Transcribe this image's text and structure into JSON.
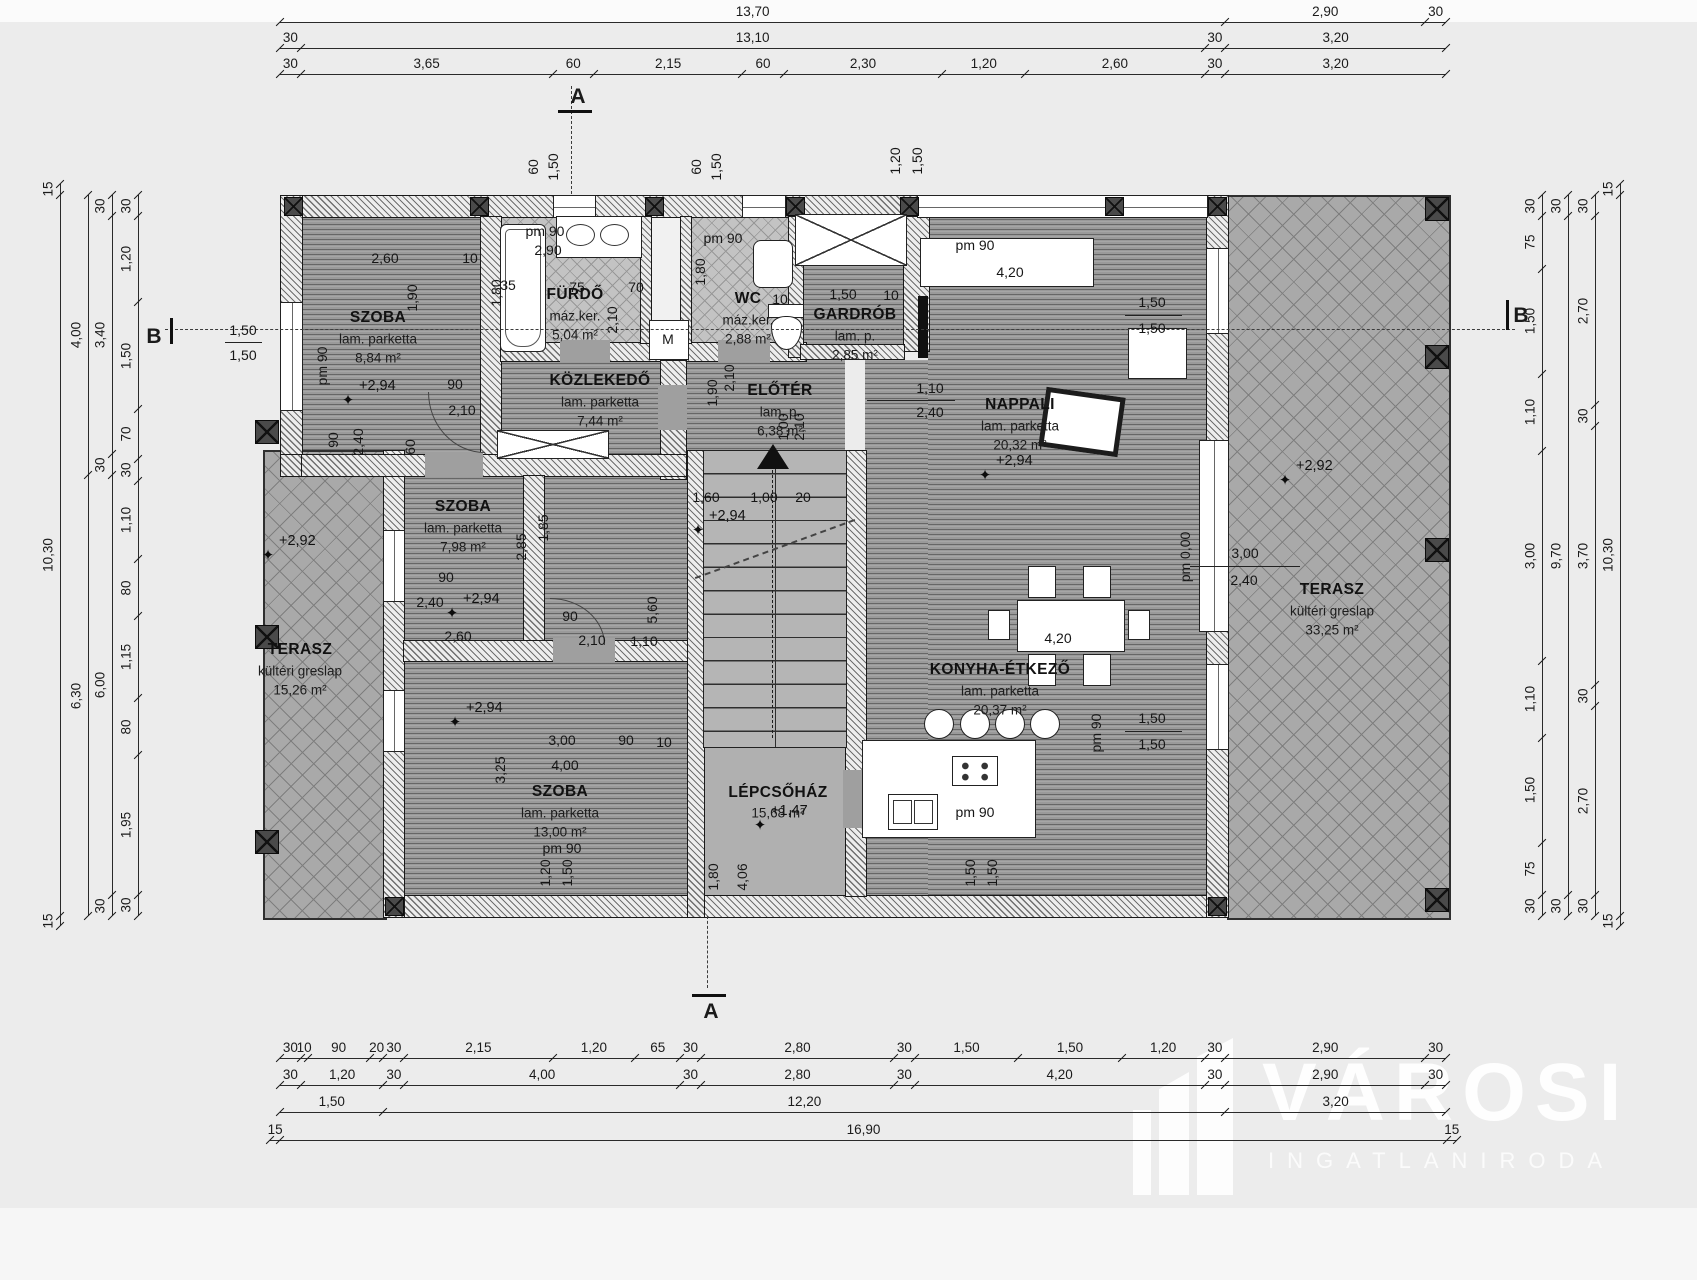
{
  "logo": {
    "name": "VÁROSI",
    "subtitle": "INGATLANIRODA"
  },
  "sections": {
    "a": "A",
    "b": "B"
  },
  "rooms": [
    {
      "name": "SZOBA",
      "finish": "lam. parketta",
      "area": "8,84 m²",
      "x": 378,
      "y": 318
    },
    {
      "name": "FÜRDŐ",
      "finish": "máz.ker.",
      "area": "5,04 m²",
      "x": 575,
      "y": 295
    },
    {
      "name": "WC",
      "finish": "máz.ker.",
      "area": "2,88 m²",
      "x": 748,
      "y": 299
    },
    {
      "name": "GARDRÓB",
      "finish": "lam. p.",
      "area": "2,85 m²",
      "x": 855,
      "y": 315
    },
    {
      "name": "KÖZLEKEDŐ",
      "finish": "lam. parketta",
      "area": "7,44 m²",
      "x": 600,
      "y": 381
    },
    {
      "name": "ELŐTÉR",
      "finish": "lam. p.",
      "area": "6,38 m²",
      "x": 780,
      "y": 391
    },
    {
      "name": "NAPPALI",
      "finish": "lam. parketta",
      "area": "20,32 m²",
      "x": 1020,
      "y": 405
    },
    {
      "name": "SZOBA",
      "finish": "lam. parketta",
      "area": "7,98 m²",
      "x": 463,
      "y": 507
    },
    {
      "name": "SZOBA",
      "finish": "lam. parketta",
      "area": "13,00 m²",
      "x": 560,
      "y": 792
    },
    {
      "name": "KONYHA-ÉTKEZŐ",
      "finish": "lam. parketta",
      "area": "20,37 m²",
      "x": 1000,
      "y": 670
    },
    {
      "name": "LÉPCSŐHÁZ",
      "finish": "",
      "area": "15,68 m²",
      "x": 778,
      "y": 793
    },
    {
      "name": "TERASZ",
      "finish": "kültéri greslap",
      "area": "15,26 m²",
      "x": 300,
      "y": 650
    },
    {
      "name": "TERASZ",
      "finish": "kültéri greslap",
      "area": "33,25 m²",
      "x": 1332,
      "y": 590
    }
  ],
  "levels": [
    {
      "v": "+2,94",
      "x": 348,
      "y": 400
    },
    {
      "v": "+2,94",
      "x": 452,
      "y": 613
    },
    {
      "v": "+2,94",
      "x": 455,
      "y": 722
    },
    {
      "v": "+2,94",
      "x": 698,
      "y": 530
    },
    {
      "v": "+2,94",
      "x": 985,
      "y": 475
    },
    {
      "v": "+1,47",
      "x": 760,
      "y": 825
    },
    {
      "v": "+2,92",
      "x": 268,
      "y": 555
    },
    {
      "v": "+2,92",
      "x": 1285,
      "y": 480
    }
  ],
  "dims": [
    {
      "t": "2,60",
      "x": 385,
      "y": 258
    },
    {
      "t": "10",
      "x": 470,
      "y": 258
    },
    {
      "t": "1,90",
      "x": 412,
      "y": 298,
      "r": 1
    },
    {
      "t": "pm 90",
      "x": 322,
      "y": 366,
      "r": 1
    },
    {
      "t": "1,50",
      "x": 243,
      "y": 330
    },
    {
      "t": "1,50",
      "x": 243,
      "y": 355
    },
    {
      "t": "90",
      "x": 333,
      "y": 440,
      "r": 1
    },
    {
      "t": "2,40",
      "x": 358,
      "y": 442,
      "r": 1
    },
    {
      "t": "60",
      "x": 410,
      "y": 447,
      "r": 1
    },
    {
      "t": "90",
      "x": 455,
      "y": 384
    },
    {
      "t": "2,10",
      "x": 462,
      "y": 410
    },
    {
      "t": "pm 90",
      "x": 545,
      "y": 231
    },
    {
      "t": "2,90",
      "x": 548,
      "y": 250
    },
    {
      "t": "35",
      "x": 508,
      "y": 285
    },
    {
      "t": "75",
      "x": 577,
      "y": 287
    },
    {
      "t": "70",
      "x": 636,
      "y": 287
    },
    {
      "t": "2,10",
      "x": 612,
      "y": 320,
      "r": 1
    },
    {
      "t": "1,80",
      "x": 496,
      "y": 293,
      "r": 1
    },
    {
      "t": "M",
      "x": 668,
      "y": 339
    },
    {
      "t": "pm 90",
      "x": 723,
      "y": 238
    },
    {
      "t": "10",
      "x": 780,
      "y": 299
    },
    {
      "t": "1,80",
      "x": 700,
      "y": 272,
      "r": 1
    },
    {
      "t": "2,10",
      "x": 729,
      "y": 378,
      "r": 1
    },
    {
      "t": "1,90",
      "x": 712,
      "y": 393,
      "r": 1
    },
    {
      "t": "1,50",
      "x": 843,
      "y": 294
    },
    {
      "t": "10",
      "x": 891,
      "y": 295
    },
    {
      "t": "1,10",
      "x": 930,
      "y": 388
    },
    {
      "t": "2,40",
      "x": 930,
      "y": 412
    },
    {
      "t": "pm 90",
      "x": 975,
      "y": 245
    },
    {
      "t": "4,20",
      "x": 1010,
      "y": 272
    },
    {
      "t": "1,50",
      "x": 1152,
      "y": 302
    },
    {
      "t": "1,50",
      "x": 1152,
      "y": 328
    },
    {
      "t": "3,00",
      "x": 1245,
      "y": 553
    },
    {
      "t": "2,40",
      "x": 1244,
      "y": 580
    },
    {
      "t": "pm 0,00",
      "x": 1185,
      "y": 557,
      "r": 1
    },
    {
      "t": "1,50",
      "x": 1152,
      "y": 718
    },
    {
      "t": "1,50",
      "x": 1152,
      "y": 744
    },
    {
      "t": "pm 90",
      "x": 1096,
      "y": 733,
      "r": 1
    },
    {
      "t": "1,60",
      "x": 706,
      "y": 497
    },
    {
      "t": "1,00",
      "x": 764,
      "y": 497
    },
    {
      "t": "20",
      "x": 803,
      "y": 497
    },
    {
      "t": "5,60",
      "x": 652,
      "y": 610,
      "r": 1
    },
    {
      "t": "2,85",
      "x": 521,
      "y": 547,
      "r": 1
    },
    {
      "t": "1,85",
      "x": 543,
      "y": 528,
      "r": 1
    },
    {
      "t": "90",
      "x": 446,
      "y": 577
    },
    {
      "t": "2,40",
      "x": 430,
      "y": 602
    },
    {
      "t": "2,60",
      "x": 458,
      "y": 636
    },
    {
      "t": "90",
      "x": 570,
      "y": 616
    },
    {
      "t": "2,10",
      "x": 592,
      "y": 640
    },
    {
      "t": "1,10",
      "x": 644,
      "y": 641
    },
    {
      "t": "3,00",
      "x": 562,
      "y": 740
    },
    {
      "t": "90",
      "x": 626,
      "y": 740
    },
    {
      "t": "10",
      "x": 664,
      "y": 742
    },
    {
      "t": "4,00",
      "x": 565,
      "y": 765
    },
    {
      "t": "3,25",
      "x": 500,
      "y": 770,
      "r": 1
    },
    {
      "t": "pm 90",
      "x": 562,
      "y": 848
    },
    {
      "t": "4,20",
      "x": 1058,
      "y": 638
    },
    {
      "t": "pm 90",
      "x": 975,
      "y": 812
    },
    {
      "t": "1,00",
      "x": 783,
      "y": 427,
      "r": 1
    },
    {
      "t": "2,10",
      "x": 799,
      "y": 427,
      "r": 1
    },
    {
      "t": "60",
      "x": 533,
      "y": 167,
      "r": 1
    },
    {
      "t": "1,50",
      "x": 553,
      "y": 167,
      "r": 1
    },
    {
      "t": "60",
      "x": 696,
      "y": 167,
      "r": 1
    },
    {
      "t": "1,50",
      "x": 716,
      "y": 167,
      "r": 1
    },
    {
      "t": "1,20",
      "x": 895,
      "y": 161,
      "r": 1
    },
    {
      "t": "1,50",
      "x": 917,
      "y": 161,
      "r": 1
    },
    {
      "t": "1,20",
      "x": 545,
      "y": 873,
      "r": 1
    },
    {
      "t": "1,50",
      "x": 567,
      "y": 873,
      "r": 1
    },
    {
      "t": "1,80",
      "x": 713,
      "y": 877,
      "r": 1
    },
    {
      "t": "4,06",
      "x": 742,
      "y": 877,
      "r": 1
    },
    {
      "t": "1,50",
      "x": 970,
      "y": 873,
      "r": 1
    },
    {
      "t": "1,50",
      "x": 992,
      "y": 873,
      "r": 1
    }
  ],
  "fractions": [
    {
      "x1": 867,
      "x2": 955,
      "y": 400
    },
    {
      "x1": 1125,
      "x2": 1182,
      "y": 315
    },
    {
      "x1": 1190,
      "x2": 1300,
      "y": 566
    },
    {
      "x1": 1125,
      "x2": 1182,
      "y": 731
    },
    {
      "x1": 225,
      "x2": 262,
      "y": 342
    }
  ],
  "chains": [
    {
      "dir": "h",
      "x": 280,
      "y": 22,
      "span": 1166,
      "segs": [
        [
          "13,70",
          13.7
        ],
        [
          "2,90",
          2.9
        ],
        [
          "30",
          0.3
        ]
      ]
    },
    {
      "dir": "h",
      "x": 280,
      "y": 48,
      "span": 1166,
      "segs": [
        [
          "30",
          0.3
        ],
        [
          "13,10",
          13.1
        ],
        [
          "30",
          0.3
        ],
        [
          "3,20",
          3.2
        ]
      ]
    },
    {
      "dir": "h",
      "x": 280,
      "y": 74,
      "span": 1166,
      "segs": [
        [
          "30",
          0.3
        ],
        [
          "3,65",
          3.65
        ],
        [
          "60",
          0.6
        ],
        [
          "2,15",
          2.15
        ],
        [
          "60",
          0.6
        ],
        [
          "2,30",
          2.3
        ],
        [
          "1,20",
          1.2
        ],
        [
          "2,60",
          2.6
        ],
        [
          "30",
          0.3
        ],
        [
          "3,20",
          3.2
        ]
      ]
    },
    {
      "dir": "h",
      "x": 280,
      "y": 1058,
      "span": 1166,
      "segs": [
        [
          "30",
          0.3
        ],
        [
          "10",
          0.1
        ],
        [
          "90",
          0.9
        ],
        [
          "20",
          0.2
        ],
        [
          "30",
          0.3
        ],
        [
          "2,15",
          2.15
        ],
        [
          "1,20",
          1.2
        ],
        [
          "65",
          0.65
        ],
        [
          "30",
          0.3
        ],
        [
          "2,80",
          2.8
        ],
        [
          "30",
          0.3
        ],
        [
          "1,50",
          1.5
        ],
        [
          "1,50",
          1.5
        ],
        [
          "1,20",
          1.2
        ],
        [
          "30",
          0.3
        ],
        [
          "2,90",
          2.9
        ],
        [
          "30",
          0.3
        ]
      ]
    },
    {
      "dir": "h",
      "x": 280,
      "y": 1085,
      "span": 1166,
      "segs": [
        [
          "30",
          0.3
        ],
        [
          "1,20",
          1.2
        ],
        [
          "30",
          0.3
        ],
        [
          "4,00",
          4.0
        ],
        [
          "30",
          0.3
        ],
        [
          "2,80",
          2.8
        ],
        [
          "30",
          0.3
        ],
        [
          "4,20",
          4.2
        ],
        [
          "30",
          0.3
        ],
        [
          "2,90",
          2.9
        ],
        [
          "30",
          0.3
        ]
      ]
    },
    {
      "dir": "h",
      "x": 280,
      "y": 1112,
      "span": 1166,
      "segs": [
        [
          "1,50",
          1.5
        ],
        [
          "12,20",
          12.2
        ],
        [
          "3,20",
          3.2
        ]
      ]
    },
    {
      "dir": "h",
      "x": 270,
      "y": 1140,
      "span": 1187,
      "segs": [
        [
          "15",
          0.15
        ],
        [
          "16,90",
          16.9
        ],
        [
          "15",
          0.15
        ]
      ]
    },
    {
      "dir": "v",
      "x": 60,
      "y": 184,
      "span": 742,
      "segs": [
        [
          "15",
          0.15
        ],
        [
          "10,30",
          10.3
        ],
        [
          "15",
          0.15
        ]
      ]
    },
    {
      "dir": "v",
      "x": 88,
      "y": 195,
      "span": 721,
      "segs": [
        [
          "4,00",
          4.0
        ],
        [
          "6,30",
          6.3
        ]
      ]
    },
    {
      "dir": "v",
      "x": 112,
      "y": 195,
      "span": 721,
      "segs": [
        [
          "30",
          0.3
        ],
        [
          "3,40",
          3.4
        ],
        [
          "30",
          0.3
        ],
        [
          "6,00",
          6.0
        ],
        [
          "30",
          0.3
        ]
      ]
    },
    {
      "dir": "v",
      "x": 138,
      "y": 195,
      "span": 721,
      "segs": [
        [
          "30",
          0.3
        ],
        [
          "1,20",
          1.2
        ],
        [
          "1,50",
          1.5
        ],
        [
          "70",
          0.7
        ],
        [
          "30",
          0.3
        ],
        [
          "1,10",
          1.1
        ],
        [
          "80",
          0.8
        ],
        [
          "1,15",
          1.15
        ],
        [
          "80",
          0.8
        ],
        [
          "1,95",
          1.95
        ],
        [
          "30",
          0.3
        ]
      ]
    },
    {
      "dir": "v",
      "x": 1542,
      "y": 195,
      "span": 721,
      "segs": [
        [
          "30",
          0.3
        ],
        [
          "75",
          0.75
        ],
        [
          "1,50",
          1.5
        ],
        [
          "1,10",
          1.1
        ],
        [
          "3,00",
          3.0
        ],
        [
          "1,10",
          1.1
        ],
        [
          "1,50",
          1.5
        ],
        [
          "75",
          0.75
        ],
        [
          "30",
          0.3
        ]
      ]
    },
    {
      "dir": "v",
      "x": 1568,
      "y": 195,
      "span": 721,
      "segs": [
        [
          "30",
          0.3
        ],
        [
          "9,70",
          9.7
        ],
        [
          "30",
          0.3
        ]
      ]
    },
    {
      "dir": "v",
      "x": 1595,
      "y": 195,
      "span": 721,
      "segs": [
        [
          "30",
          0.3
        ],
        [
          "2,70",
          2.7
        ],
        [
          "30",
          0.3
        ],
        [
          "3,70",
          3.7
        ],
        [
          "30",
          0.3
        ],
        [
          "2,70",
          2.7
        ],
        [
          "30",
          0.3
        ]
      ]
    },
    {
      "dir": "v",
      "x": 1620,
      "y": 184,
      "span": 742,
      "segs": [
        [
          "15",
          0.15
        ],
        [
          "10,30",
          10.3
        ],
        [
          "15",
          0.15
        ]
      ]
    }
  ]
}
